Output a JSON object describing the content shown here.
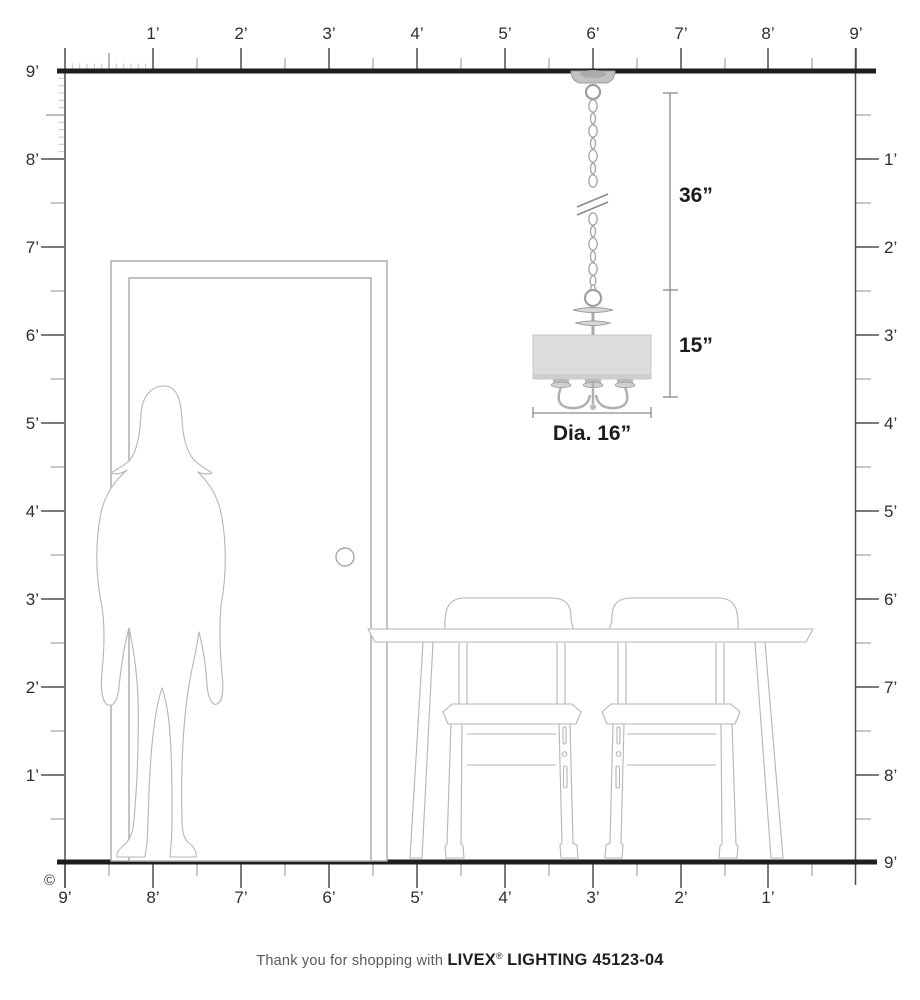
{
  "rulers": {
    "top": {
      "labels": [
        "1’",
        "2’",
        "3’",
        "4’",
        "5’",
        "6’",
        "7’",
        "8’",
        "9’"
      ]
    },
    "left": {
      "labels": [
        "9’",
        "8’",
        "7’",
        "6’",
        "5’",
        "4’",
        "3’",
        "2’",
        "1’"
      ]
    },
    "right": {
      "labels": [
        "1’",
        "2’",
        "3’",
        "4’",
        "5’",
        "6’",
        "7’",
        "8’",
        "9’"
      ]
    },
    "bottom": {
      "labels": [
        "9’",
        "8’",
        "7’",
        "6’",
        "5’",
        "4’",
        "3’",
        "2’",
        "1’"
      ]
    }
  },
  "dimensions": {
    "hang_length": "36”",
    "fixture_height": "15”",
    "diameter": "Dia. 16”"
  },
  "copyright_symbol": "©",
  "footer": {
    "prefix": "Thank you for shopping with",
    "brand": "LIVEX",
    "registered": "®",
    "product": "LIGHTING 45123-04"
  },
  "colors": {
    "structure_line": "#1e1e1e",
    "ruler_line": "#4d4d4d",
    "drawing_gray": "#b5b5b5",
    "shade_fill": "#dcdcdc"
  }
}
